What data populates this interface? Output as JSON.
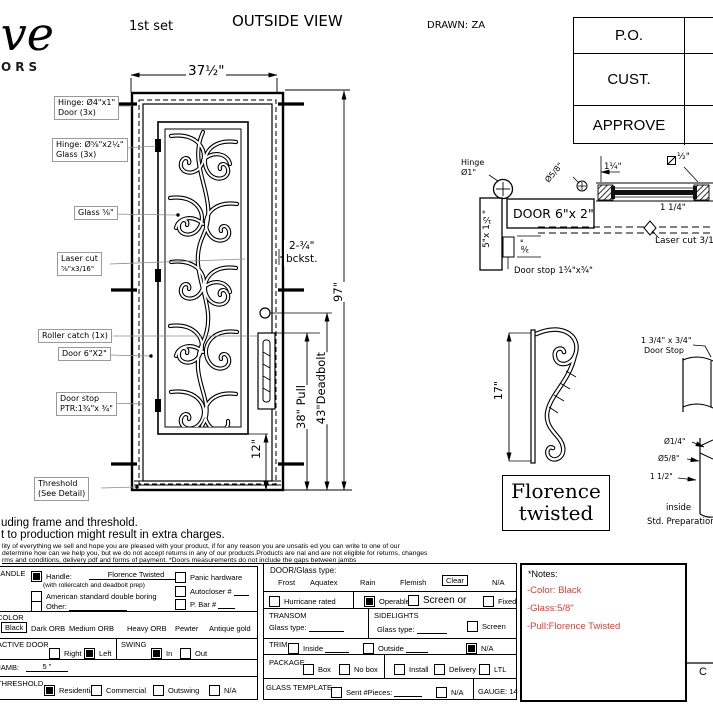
{
  "page": {
    "bg": "#ffffff",
    "ink": "#000000",
    "red": "#e8392e"
  },
  "header": {
    "logo_script": "ive",
    "logo_sub": "ORS",
    "set_label": "1st set",
    "title": "OUTSIDE VIEW",
    "drawn_by": "DRAWN: ZA",
    "approval_rows": [
      "P.O.",
      "CUST.",
      "APPROVE"
    ]
  },
  "elevation": {
    "dim_width": "37½\"",
    "dim_height": "97\"",
    "dim_pull": "38\" Pull",
    "dim_deadbolt": "43\"Deadbolt",
    "dim_bottom": "12\"",
    "dim_backset_value": "2-¾\"",
    "dim_backset_label": "bckst.",
    "callouts": {
      "hinge_door_line1": "Hinge: Ø4\"x1\"",
      "hinge_door_line2": "Door (3x)",
      "hinge_glass_line1": "Hinge: Ø⅝\"x2¼\"",
      "hinge_glass_line2": "Glass (3x)",
      "glass": "Glass ⅝\"",
      "laser_line1": "Laser cut",
      "laser_line2": "⅝\"x3/16\"",
      "roller_catch": "Roller catch  (1x)",
      "door": "Door  6\"X2\"",
      "door_stop_line1": "Door stop",
      "door_stop_line2": "PTR:1¾\"x ¾\"",
      "threshold_line1": "Threshold",
      "threshold_line2": "(See Detail)"
    }
  },
  "section_detail": {
    "hinge_line1": "Hinge",
    "hinge_line2": "Ø1\"",
    "door_label": "DOOR 6\"x 2\"",
    "jamb_dim": "5\"x 1½\"",
    "stop_offset_dim": "⅜\"",
    "door_stop": "Door stop 1¾\"x¾\"",
    "glass_hinge_dim": "Ø5/8\"",
    "gap_dim": "1¼\"",
    "half_dim": "½\"",
    "glass_width_dim": "1 1/4\"",
    "laser_cut": "Laser cut 3/16"
  },
  "pull_detail": {
    "dim": "17\"",
    "name_line1": "Florence",
    "name_line2": "twisted"
  },
  "stop_detail": {
    "label_line1": "1 3/4\" x 3/4\"",
    "label_line2": "Door Stop",
    "dia_quarter": "Ø1/4\"",
    "dia_fiveeighths": "Ø5/8\"",
    "dim_oneandhalf": "1 1/2\"",
    "inside": "inside",
    "caption": "Std. Preparation"
  },
  "disclaimer": {
    "line1": "uding frame and threshold.",
    "line2": "t to production might result in extra charges.",
    "line3": "lity of everything we sell and hope you are pleased with your product, if for any reason you are unsatis   ed you can write to one of our",
    "line4": "determine how can we help you, but we do not accept returns in any of our products.Products are    nal and are not eligible for returns, changes",
    "line5": "rms and conditions, delivery pdf and forms of payment. *Doors measurements do not include the gaps between jambs"
  },
  "form": {
    "handle": {
      "section_label": "HANDLE",
      "handle_checked": true,
      "handle_label": "Handle:",
      "handle_value": "Florence Twisted",
      "handle_note": "(with rollercatch and deadbolt prep)",
      "american_checked": false,
      "american_label": "American standard double boring",
      "other_checked": false,
      "other_label": "Other:",
      "panic_checked": false,
      "panic_label": "Panic hardware",
      "autocloser_checked": false,
      "autocloser_label": "Autocloser #",
      "pbar_checked": false,
      "pbar_label": "P. Bar #"
    },
    "color": {
      "section_label": "COLOR",
      "selected": "Black",
      "options": [
        "Dark ORB",
        "Medium ORB",
        "Heavy ORB",
        "Pewter",
        "Antique gold"
      ]
    },
    "active_door": {
      "section_label": "ACTIVE DOOR",
      "right_label": "Right",
      "right_checked": false,
      "left_label": "Left",
      "left_checked": true
    },
    "swing": {
      "section_label": "SWING",
      "in_label": "In",
      "in_checked": true,
      "out_label": "Out",
      "out_checked": false
    },
    "jamb": {
      "section_label": "JAMB:",
      "value": "5 \""
    },
    "threshold": {
      "section_label": "THRESHOLD",
      "options": [
        {
          "label": "Residential",
          "checked": true
        },
        {
          "label": "Commercial",
          "checked": false
        },
        {
          "label": "Outswing",
          "checked": false
        },
        {
          "label": "N/A",
          "checked": false
        }
      ]
    },
    "glass_type": {
      "section_label": "DOOR/Glass type:",
      "options": [
        "Frost",
        "Aquatex",
        "Rain",
        "Flemish"
      ],
      "selected": "Clear",
      "na": "N/A"
    },
    "hurricane": {
      "label": "Hurricane rated",
      "checked": false
    },
    "operable": {
      "operable_label": "Operable",
      "operable_checked": true,
      "screen_label": "Screen or",
      "screen_checked": false,
      "fixed_label": "Fixed",
      "fixed_checked": false
    },
    "transom": {
      "section_label": "TRANSOM",
      "glass_label": "Glass type:"
    },
    "sidelights": {
      "section_label": "SIDELIGHTS",
      "glass_label": "Glass type:",
      "screen_label": "Screen",
      "screen_checked": false
    },
    "trim": {
      "section_label": "TRIM",
      "inside_label": "Inside",
      "inside_checked": false,
      "outside_label": "Outside",
      "outside_checked": false,
      "na_label": "N/A",
      "na_checked": true
    },
    "package": {
      "section_label": "PACKAGE",
      "box_label": "Box",
      "box_checked": false,
      "nobox_label": "No box",
      "nobox_checked": false,
      "install_label": "Install",
      "install_checked": false,
      "delivery_label": "Delivery",
      "delivery_checked": false,
      "ltl_label": "LTL",
      "ltl_checked": false
    },
    "glass_template": {
      "section_label": "GLASS TEMPLATE",
      "sent_label": "Sent #Pieces:",
      "sent_checked": false,
      "na_label": "N/A",
      "na_checked": false,
      "gauge_label": "GAUGE: 14"
    },
    "notes": {
      "title": "*Notes:",
      "lines": [
        "-Color: Black",
        "-Glass:5/8\"",
        "-Pull:Florence Twisted"
      ]
    }
  },
  "signature": {
    "label": "C"
  }
}
